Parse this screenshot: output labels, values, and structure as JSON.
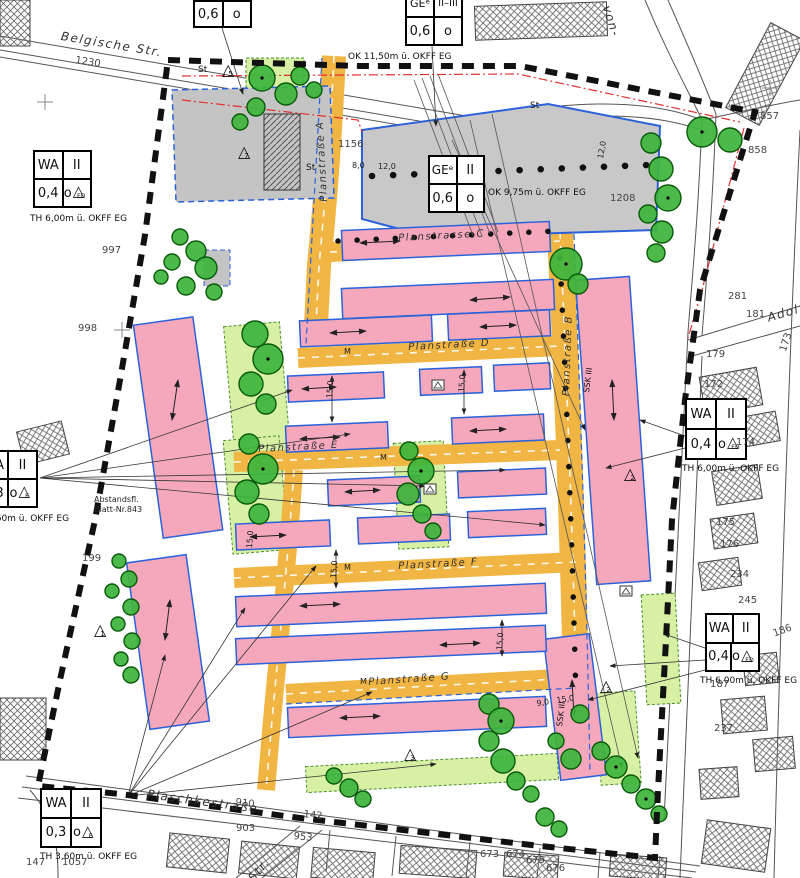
{
  "colors": {
    "road_yellow": "#F0B542",
    "building_planned_pink": "#F5A8BC",
    "building_existing_gray": "#C4C4C4",
    "tree_green": "#3CB43C",
    "green_area": "#D8F0A4",
    "plan_boundary": "#111111",
    "outline_blue": "#2B62D9",
    "line_red": "#E03030"
  },
  "icons": {
    "triangle": "△",
    "north_dash": "—"
  },
  "streets": {
    "belgische": "Belgische Str.",
    "plaschke": "Plaschkestraße",
    "adolf": "Adolf-",
    "von": "von-",
    "str_bl": "Str.",
    "plan_a": "Planstraße A",
    "plan_b": "Planstraße B",
    "plan_c": "Planstrasse C",
    "plan_d": "Planstraße D",
    "plan_e": "Planstraße E",
    "plan_f": "Planstraße F",
    "plan_g": "Planstraße G"
  },
  "boxes": {
    "top": {
      "grz": "0,6",
      "open": "o"
    },
    "ge_top": {
      "use": "GEᵉ",
      "floors": "II–III",
      "grz": "0,6",
      "open": "o",
      "caption": "OK 11,50m ü. OKFF EG"
    },
    "ge_mid": {
      "use": "GEᵉ",
      "floors": "II",
      "grz": "0,6",
      "open": "o",
      "caption": "OK 9,75m ü. OKFF EG"
    },
    "wa_left": {
      "use": "WA",
      "floors": "II",
      "grz": "0,4",
      "open": "o",
      "tri": "ED",
      "caption": "TH 6,00m ü. OKFF EG"
    },
    "wa_right": {
      "use": "WA",
      "floors": "II",
      "grz": "0,4",
      "open": "o",
      "tri": "ED",
      "caption": "TH 6,00m ü. OKFF EG"
    },
    "wa_right2": {
      "use": "WA",
      "floors": "II",
      "grz": "0,4",
      "open": "o",
      "tri": "ED",
      "caption": "TH 6,00m ü. OKFF EG"
    },
    "wa_bottom": {
      "use": "WA",
      "floors": "II",
      "grz": "0,3",
      "open": "o",
      "tri": "E",
      "caption": "TH 3,60m ü. OKFF EG"
    },
    "wa_edge": {
      "use": "WA",
      "floors": "II",
      "grz": "0,3",
      "open": "o",
      "tri": "E",
      "caption": "TH 3,60m ü. OKFF EG"
    }
  },
  "parcels": {
    "n1230": "1230",
    "n997": "997",
    "n998": "998",
    "n199": "199",
    "n1156": "1156",
    "n1208": "1208",
    "n857": "857",
    "n858": "858",
    "n281": "281",
    "n181": "181",
    "n179": "179",
    "n173": "173",
    "n172": "172",
    "n174": "174",
    "n175": "175",
    "n176": "176",
    "n234": "234",
    "n245": "245",
    "n186": "186",
    "n187": "187",
    "n237": "237",
    "n147": "147",
    "n1057": "1057",
    "n910": "910",
    "n142": "142",
    "n903": "903",
    "n953": "953",
    "n673": "673",
    "n674": "674",
    "n675": "675",
    "n676": "676"
  },
  "dims": {
    "d1": "8,0",
    "d2": "12,0",
    "d3": "15,0",
    "d4": "15,0",
    "d5": "15,0",
    "d6": "15,0",
    "d7": "9,0",
    "d8": "15,0",
    "d9": "12,0",
    "d10": "15,0"
  },
  "misc": {
    "st": "St",
    "m": "M",
    "ssk": "SSK III",
    "abstandsfl": "Abstandsfl.",
    "blatt": "Blatt-Nr.843"
  },
  "triangles": {
    "t1": "5",
    "t2": "7",
    "t3": "1",
    "t4": "2",
    "t5": "3",
    "t6": "2"
  }
}
